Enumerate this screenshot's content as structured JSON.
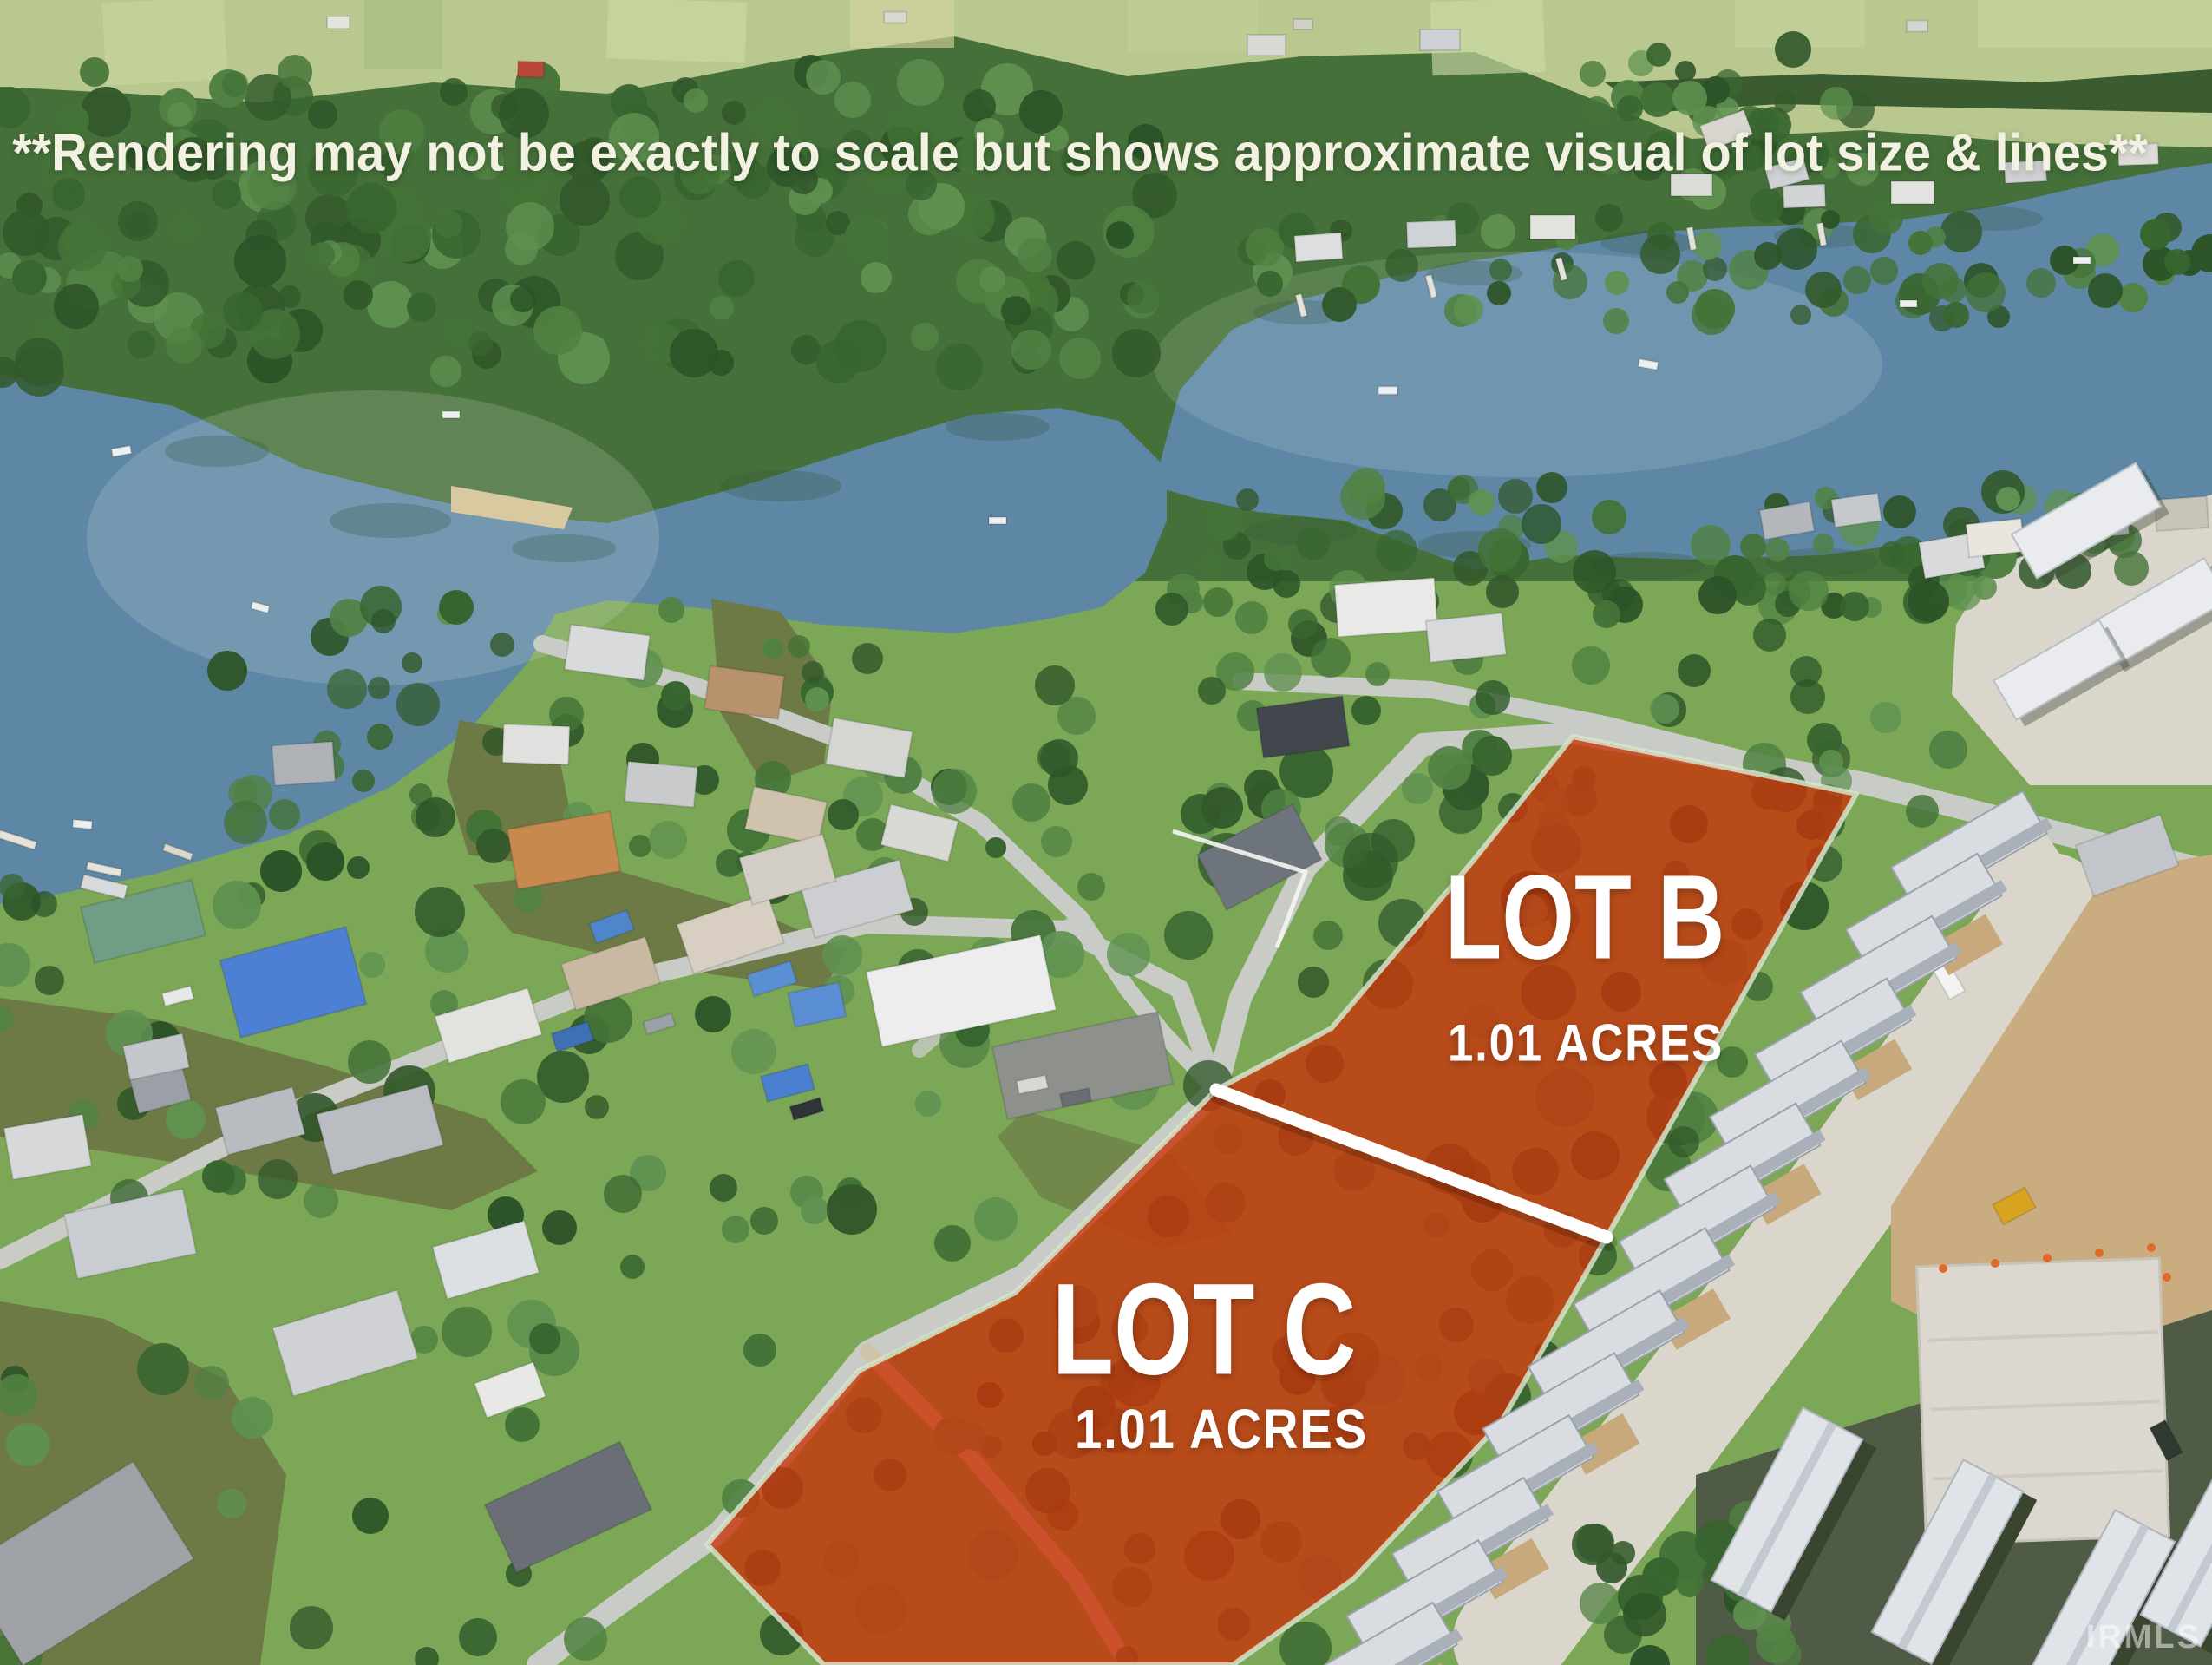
{
  "disclaimer": "**Rendering may not be exactly to scale but shows approximate visual of lot size & lines**",
  "lots": [
    {
      "label": "LOT B",
      "acreage": "1.01 ACRES"
    },
    {
      "label": "LOT C",
      "acreage": "1.01 ACRES"
    }
  ],
  "watermark": "IRMLS",
  "colors": {
    "lot_overlay": "#c8350b",
    "lot_outline": "#d5e4cc",
    "divider": "#ffffff",
    "disclaimer_text": "#f2f1e2",
    "label_text": "#ffffff",
    "lake": "#5d87a4",
    "field": "#b9c88f",
    "forest": "#46703a",
    "lawn": "#7ba757",
    "road": "#c9ccc6",
    "canal": "#6e7a45",
    "gravel": "#c9ac80",
    "concrete": "#dbd6cb",
    "roof": "#d9dce1"
  }
}
